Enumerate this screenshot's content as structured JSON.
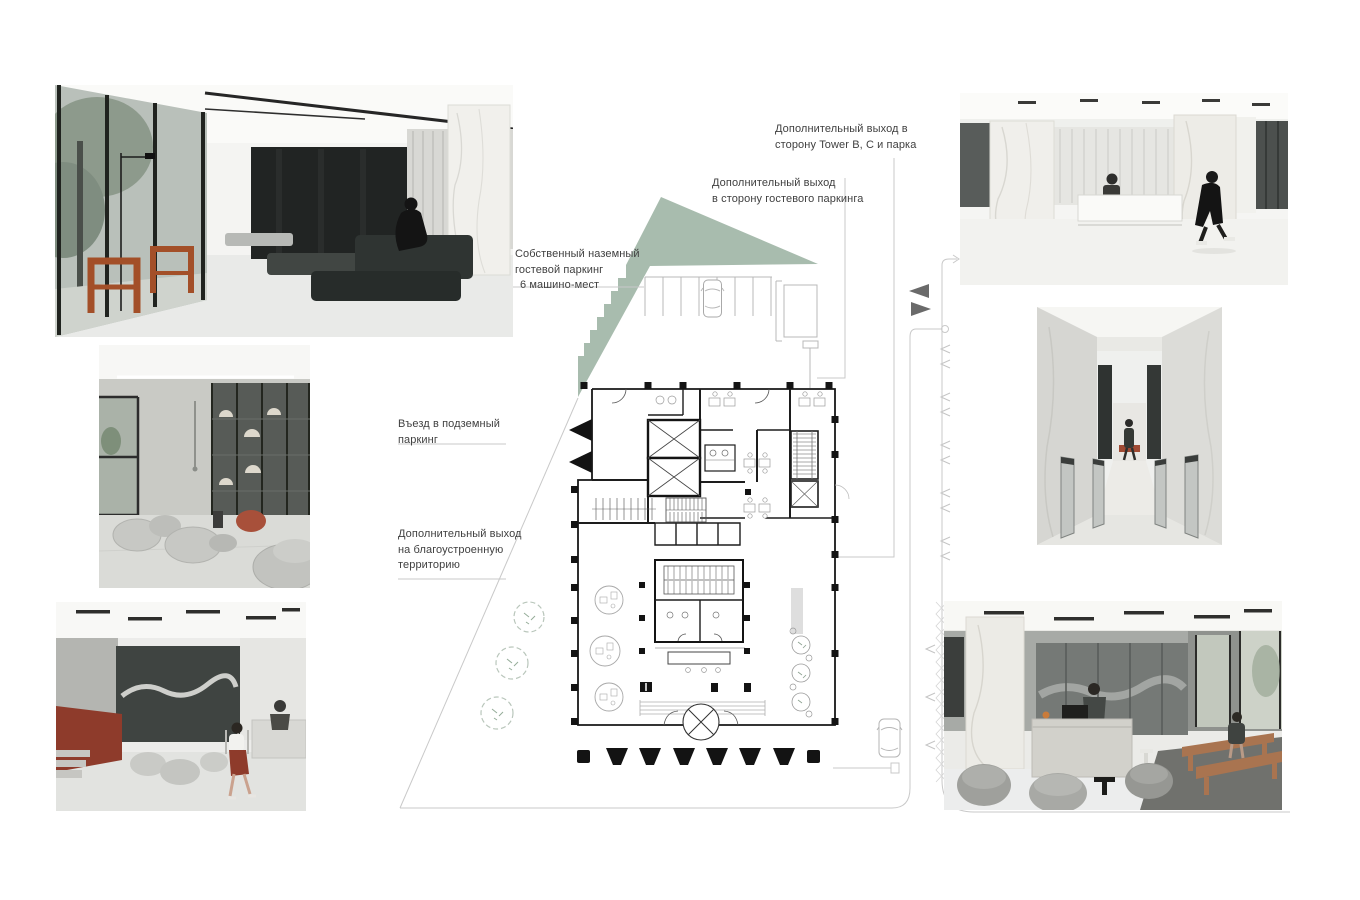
{
  "board": {
    "background": "#ffffff"
  },
  "annotations": {
    "towers_exit": {
      "lines": [
        "Дополнительный выход в",
        "сторону Tower B, C и парка"
      ]
    },
    "guest_parking_exit": {
      "lines": [
        "Дополнительный выход",
        "в сторону гостевого паркинга"
      ]
    },
    "own_parking": {
      "lines": [
        "Собственный наземный",
        "гостевой паркинг",
        "6 машино-мест"
      ]
    },
    "underground_entry": {
      "lines": [
        "Въезд в подземный",
        "паркинг"
      ]
    },
    "landscaped_exit": {
      "lines": [
        "Дополнительный выход",
        "на благоустроенную",
        "территорию"
      ]
    }
  },
  "renders": [
    {
      "id": "lobby-lounge-wide",
      "subject": "lobby lounge with dark sofas, timber frame chairs and glass facade"
    },
    {
      "id": "lounge-glass-partition",
      "subject": "lounge with curved grey poufs, red chair and glass shelving partition"
    },
    {
      "id": "entrance-hall-reception",
      "subject": "entrance hall with corten wall, poufs and reception desk"
    },
    {
      "id": "reception-hall-marble",
      "subject": "white marble hall with long reception desk and walking visitor"
    },
    {
      "id": "elevator-lobby-turnstiles",
      "subject": "elevator lobby with marble walls and speed-gate turnstiles"
    },
    {
      "id": "cafe-lounge",
      "subject": "lobby cafe with stone counter, tub chairs and timber benches"
    }
  ],
  "site_plan": {
    "features": [
      "guest-parking-stalls",
      "underground-ramp-entry",
      "revolving-door",
      "elevator-core",
      "stairs",
      "service-road",
      "street-trees",
      "landscaped-green-wedge"
    ]
  },
  "colors": {
    "site_green": "#a8bcae",
    "line_gray": "#c9c9c9",
    "wall_black": "#171717",
    "corten_red": "#8e3b2b",
    "timber": "#a34f28",
    "traffic_arrow_gray": "#6a6a6a"
  }
}
